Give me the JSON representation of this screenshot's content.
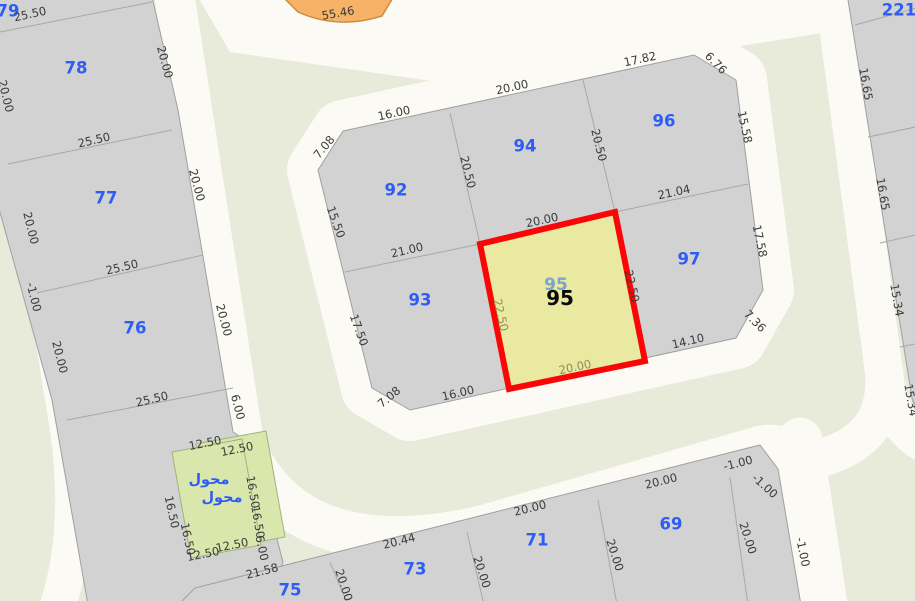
{
  "colors": {
    "background": "#e8ebd9",
    "road": "#fbfaf4",
    "block": "#d2d2d2",
    "block_border": "#a0a0a0",
    "parcel_number": "#2e5cf6",
    "dimension_text": "#3a3a3a",
    "selected_fill": "#e9e9a2",
    "selected_border": "#fa0606",
    "transformer_fill": "#d9e7ac",
    "orange_fill": "#f6b266"
  },
  "selected_parcel": "95",
  "map": {
    "labels": [
      {
        "text": "79",
        "x": 8,
        "y": 11,
        "rot": 0,
        "cls": "parcel"
      },
      {
        "text": "78",
        "x": 76,
        "y": 68,
        "rot": 0,
        "cls": "parcel"
      },
      {
        "text": "77",
        "x": 106,
        "y": 198,
        "rot": 0,
        "cls": "parcel"
      },
      {
        "text": "76",
        "x": 135,
        "y": 328,
        "rot": 0,
        "cls": "parcel"
      },
      {
        "text": "92",
        "x": 396,
        "y": 190,
        "rot": 0,
        "cls": "parcel"
      },
      {
        "text": "94",
        "x": 525,
        "y": 146,
        "rot": 0,
        "cls": "parcel"
      },
      {
        "text": "96",
        "x": 664,
        "y": 121,
        "rot": 0,
        "cls": "parcel"
      },
      {
        "text": "93",
        "x": 420,
        "y": 300,
        "rot": 0,
        "cls": "parcel"
      },
      {
        "text": "97",
        "x": 689,
        "y": 259,
        "rot": 0,
        "cls": "parcel"
      },
      {
        "text": "69",
        "x": 671,
        "y": 524,
        "rot": 0,
        "cls": "parcel"
      },
      {
        "text": "71",
        "x": 537,
        "y": 540,
        "rot": 0,
        "cls": "parcel"
      },
      {
        "text": "73",
        "x": 415,
        "y": 569,
        "rot": 0,
        "cls": "parcel"
      },
      {
        "text": "75",
        "x": 290,
        "y": 590,
        "rot": 0,
        "cls": "parcel"
      },
      {
        "text": "221",
        "x": 899,
        "y": 10,
        "rot": 0,
        "cls": "parcel"
      },
      {
        "text": "محول",
        "x": 209,
        "y": 480,
        "rot": 0,
        "cls": "arabic"
      },
      {
        "text": "محول",
        "x": 222,
        "y": 498,
        "rot": 0,
        "cls": "arabic"
      },
      {
        "text": "95",
        "x": 556,
        "y": 285,
        "rot": 0,
        "cls": "sel-under"
      },
      {
        "text": "95",
        "x": 560,
        "y": 298,
        "rot": 0,
        "cls": "sel"
      },
      {
        "text": "25.50",
        "x": 30,
        "y": 14,
        "rot": -12,
        "cls": "dim"
      },
      {
        "text": "25.50",
        "x": 94,
        "y": 140,
        "rot": -13,
        "cls": "dim"
      },
      {
        "text": "25.50",
        "x": 122,
        "y": 267,
        "rot": -13,
        "cls": "dim"
      },
      {
        "text": "25.50",
        "x": 152,
        "y": 399,
        "rot": -13,
        "cls": "dim"
      },
      {
        "text": "20.00",
        "x": 6,
        "y": 96,
        "rot": 76,
        "cls": "dim"
      },
      {
        "text": "20.00",
        "x": 31,
        "y": 228,
        "rot": 76,
        "cls": "dim"
      },
      {
        "text": "-1.00",
        "x": 34,
        "y": 297,
        "rot": 76,
        "cls": "dim"
      },
      {
        "text": "20.00",
        "x": 60,
        "y": 357,
        "rot": 76,
        "cls": "dim"
      },
      {
        "text": "20.00",
        "x": 165,
        "y": 62,
        "rot": 75,
        "cls": "dim"
      },
      {
        "text": "20.00",
        "x": 197,
        "y": 185,
        "rot": 75,
        "cls": "dim"
      },
      {
        "text": "20.00",
        "x": 224,
        "y": 320,
        "rot": 75,
        "cls": "dim"
      },
      {
        "text": "6.00",
        "x": 238,
        "y": 407,
        "rot": 75,
        "cls": "dim"
      },
      {
        "text": "7.08",
        "x": 324,
        "y": 147,
        "rot": -50,
        "cls": "dim"
      },
      {
        "text": "16.00",
        "x": 394,
        "y": 113,
        "rot": -12,
        "cls": "dim"
      },
      {
        "text": "20.00",
        "x": 512,
        "y": 87,
        "rot": -12,
        "cls": "dim"
      },
      {
        "text": "17.82",
        "x": 640,
        "y": 59,
        "rot": -12,
        "cls": "dim"
      },
      {
        "text": "6.76",
        "x": 716,
        "y": 63,
        "rot": 45,
        "cls": "dim"
      },
      {
        "text": "20.50",
        "x": 468,
        "y": 172,
        "rot": 76,
        "cls": "dim"
      },
      {
        "text": "20.50",
        "x": 599,
        "y": 145,
        "rot": 76,
        "cls": "dim"
      },
      {
        "text": "15.50",
        "x": 336,
        "y": 222,
        "rot": 70,
        "cls": "dim"
      },
      {
        "text": "21.04",
        "x": 674,
        "y": 192,
        "rot": -12,
        "cls": "dim"
      },
      {
        "text": "15.58",
        "x": 745,
        "y": 127,
        "rot": 78,
        "cls": "dim"
      },
      {
        "text": "17.58",
        "x": 760,
        "y": 241,
        "rot": 78,
        "cls": "dim"
      },
      {
        "text": "21.00",
        "x": 407,
        "y": 250,
        "rot": -13,
        "cls": "dim"
      },
      {
        "text": "17.50",
        "x": 359,
        "y": 330,
        "rot": 70,
        "cls": "dim"
      },
      {
        "text": "7.08",
        "x": 389,
        "y": 397,
        "rot": -40,
        "cls": "dim"
      },
      {
        "text": "16.00",
        "x": 458,
        "y": 393,
        "rot": -13,
        "cls": "dim"
      },
      {
        "text": "20.00",
        "x": 542,
        "y": 220,
        "rot": -12,
        "cls": "dim"
      },
      {
        "text": "22.50",
        "x": 632,
        "y": 286,
        "rot": 77,
        "cls": "dim"
      },
      {
        "text": "14.10",
        "x": 688,
        "y": 341,
        "rot": -13,
        "cls": "dim"
      },
      {
        "text": "7.36",
        "x": 755,
        "y": 321,
        "rot": 45,
        "cls": "dim"
      },
      {
        "text": "22.50",
        "x": 501,
        "y": 315,
        "rot": 77,
        "cls": "dim-olive"
      },
      {
        "text": "20.00",
        "x": 575,
        "y": 367,
        "rot": -12,
        "cls": "dim-olive"
      },
      {
        "text": "16.65",
        "x": 866,
        "y": 84,
        "rot": 80,
        "cls": "dim"
      },
      {
        "text": "16.65",
        "x": 883,
        "y": 194,
        "rot": 80,
        "cls": "dim"
      },
      {
        "text": "15.34",
        "x": 897,
        "y": 300,
        "rot": 80,
        "cls": "dim"
      },
      {
        "text": "15.34",
        "x": 911,
        "y": 400,
        "rot": 80,
        "cls": "dim"
      },
      {
        "text": "12.50",
        "x": 205,
        "y": 443,
        "rot": -11,
        "cls": "dim"
      },
      {
        "text": "12.50",
        "x": 237,
        "y": 449,
        "rot": -11,
        "cls": "dim"
      },
      {
        "text": "16.50",
        "x": 172,
        "y": 512,
        "rot": 78,
        "cls": "dim"
      },
      {
        "text": "16.50",
        "x": 188,
        "y": 539,
        "rot": 78,
        "cls": "dim"
      },
      {
        "text": "16.50",
        "x": 253,
        "y": 492,
        "rot": 80,
        "cls": "dim"
      },
      {
        "text": "16.50",
        "x": 258,
        "y": 522,
        "rot": 80,
        "cls": "dim"
      },
      {
        "text": "12.50",
        "x": 232,
        "y": 545,
        "rot": -11,
        "cls": "dim"
      },
      {
        "text": "12.50",
        "x": 203,
        "y": 554,
        "rot": -11,
        "cls": "dim"
      },
      {
        "text": "6.00",
        "x": 262,
        "y": 548,
        "rot": 78,
        "cls": "dim"
      },
      {
        "text": "21.58",
        "x": 262,
        "y": 571,
        "rot": -14,
        "cls": "dim"
      },
      {
        "text": "20.44",
        "x": 399,
        "y": 541,
        "rot": -14,
        "cls": "dim"
      },
      {
        "text": "20.00",
        "x": 530,
        "y": 508,
        "rot": -14,
        "cls": "dim"
      },
      {
        "text": "20.00",
        "x": 661,
        "y": 481,
        "rot": -14,
        "cls": "dim"
      },
      {
        "text": "-1.00",
        "x": 738,
        "y": 463,
        "rot": -14,
        "cls": "dim"
      },
      {
        "text": "-1.00",
        "x": 765,
        "y": 486,
        "rot": 42,
        "cls": "dim"
      },
      {
        "text": "20.00",
        "x": 344,
        "y": 585,
        "rot": 72,
        "cls": "dim"
      },
      {
        "text": "20.00",
        "x": 482,
        "y": 572,
        "rot": 72,
        "cls": "dim"
      },
      {
        "text": "20.00",
        "x": 615,
        "y": 555,
        "rot": 72,
        "cls": "dim"
      },
      {
        "text": "20.00",
        "x": 748,
        "y": 538,
        "rot": 72,
        "cls": "dim"
      },
      {
        "text": "-1.00",
        "x": 803,
        "y": 552,
        "rot": 78,
        "cls": "dim"
      },
      {
        "text": "55.46",
        "x": 338,
        "y": 13,
        "rot": -10,
        "cls": "dim"
      }
    ]
  }
}
